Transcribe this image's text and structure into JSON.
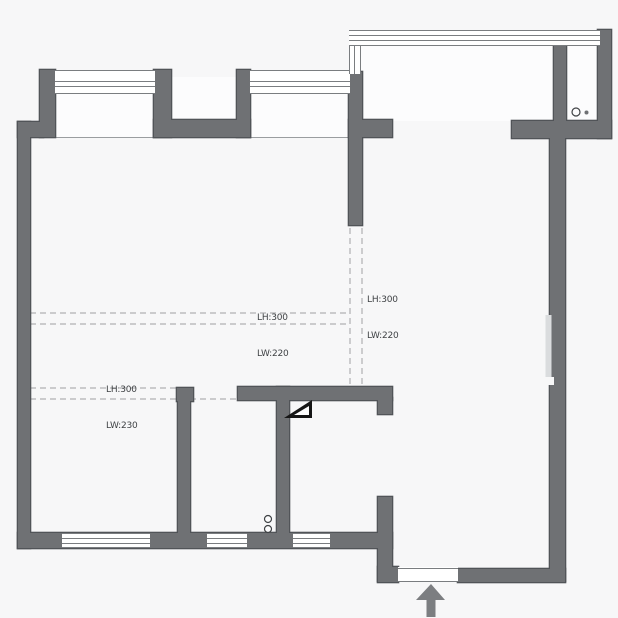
{
  "title": "apartment-floor-plan",
  "annotations": {
    "beam_left": {
      "line1": "LH:300",
      "line2": "LW:220"
    },
    "beam_right": {
      "line1": "LH:300",
      "line2": "LW:220"
    },
    "beam_bottom": {
      "line1": "LH:300",
      "line2": "LW:230"
    },
    "ceiling_height": "CH:2755"
  },
  "icons": {
    "entrance_arrow": "up-arrow",
    "door_swing": "filled-door-swing",
    "door_leaf": "open-door-leaf-line",
    "wall_fixtures_top_right": "circle-pair",
    "wall_fixtures_bathroom": "stacked-circle-pair"
  },
  "colors": {
    "background": "#f7f7f8",
    "wall_fill": "#6f7174",
    "wall_outline": "#515458",
    "window_line": "#7a7d80",
    "recess_fill": "#fcfcfd",
    "dashed_line": "#b1b1b3",
    "thin_line": "#9a9da0",
    "annotation_text": "#3f4245",
    "arrow": "#7c7e81",
    "door_swing": "#161616",
    "door_leaf": "#dadcde"
  }
}
